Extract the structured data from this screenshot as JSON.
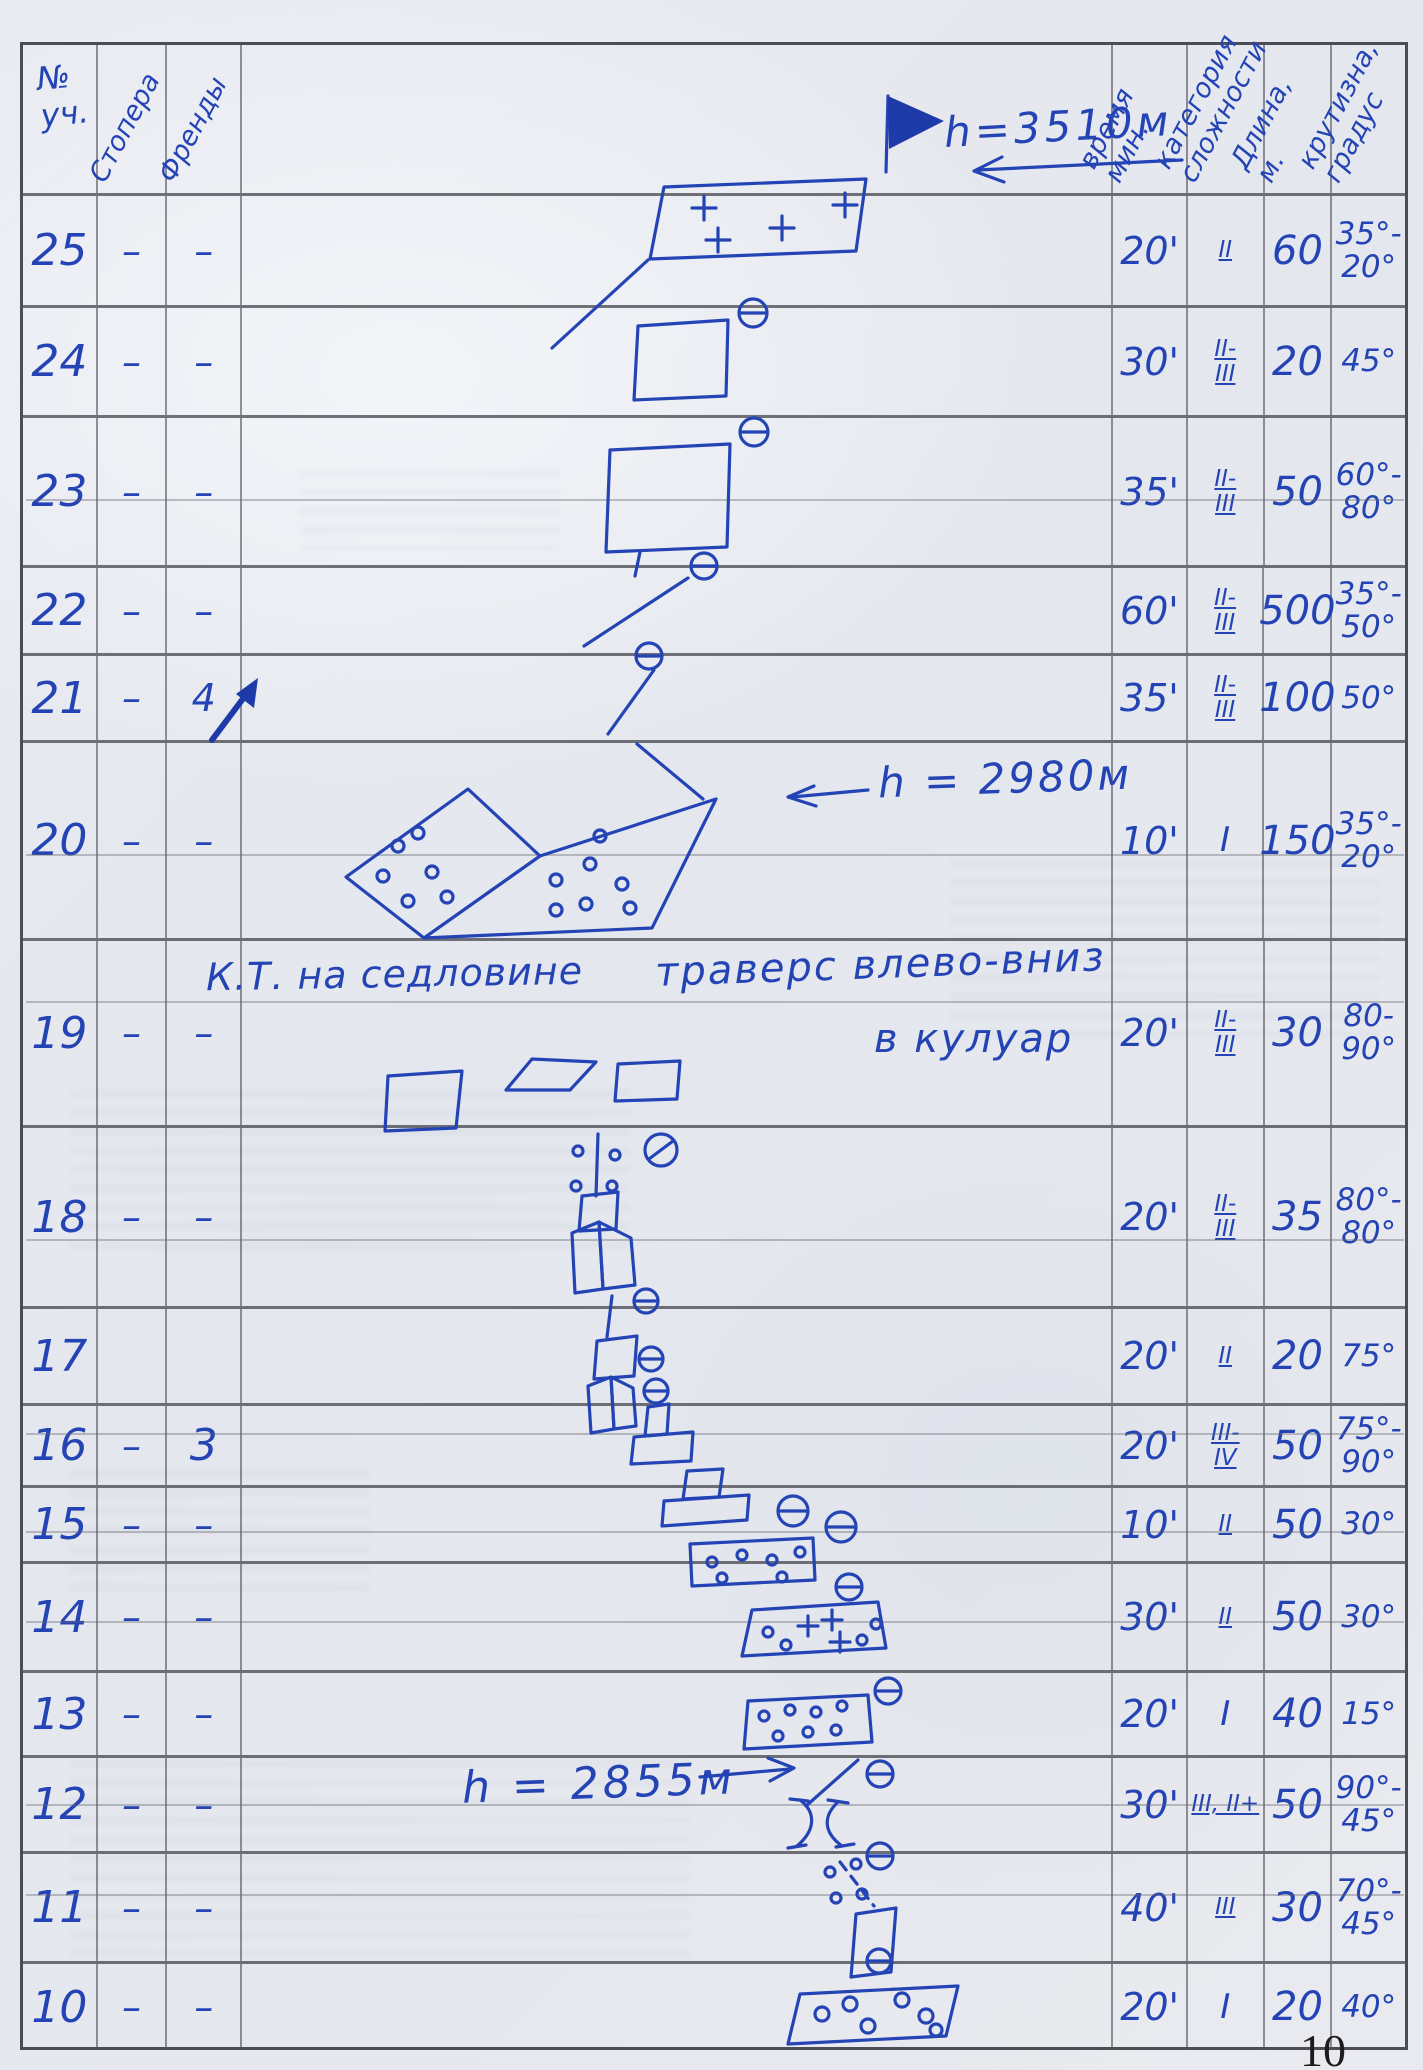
{
  "page": {
    "number": "10"
  },
  "header": {
    "col_num": "№\nуч.",
    "col_stoppers": "Стопера",
    "col_friends": "Френды",
    "col_time": "время\nмин.",
    "col_category": "категория\nсложности",
    "col_length": "Длина,\nм.",
    "col_steepness": "крутизна,\nградус"
  },
  "annotations": {
    "summit_height": "h=3510м",
    "saddle_height": "h = 2980м",
    "mid_height": "h = 2855м",
    "kt_note": "К.Т. на седловине",
    "traverse_note": "траверс влево-вниз",
    "couloir_note": "в кулуар"
  },
  "rows": [
    {
      "num": "25",
      "stoppers": "–",
      "friends": "–",
      "time": "20'",
      "category": "II",
      "length": "60",
      "steepness": "35°-\n20°"
    },
    {
      "num": "24",
      "stoppers": "–",
      "friends": "–",
      "time": "30'",
      "category": "II-\nIII",
      "length": "20",
      "steepness": "45°"
    },
    {
      "num": "23",
      "stoppers": "–",
      "friends": "–",
      "time": "35'",
      "category": "II-\nIII",
      "length": "50",
      "steepness": "60°-\n80°"
    },
    {
      "num": "22",
      "stoppers": "–",
      "friends": "–",
      "time": "60'",
      "category": "II-\nIII",
      "length": "500",
      "steepness": "35°-\n50°"
    },
    {
      "num": "21",
      "stoppers": "–",
      "friends": "4",
      "time": "35'",
      "category": "II-\nIII",
      "length": "100",
      "steepness": "50°"
    },
    {
      "num": "20",
      "stoppers": "–",
      "friends": "–",
      "time": "10'",
      "category": "I",
      "length": "150",
      "steepness": "35°-\n20°"
    },
    {
      "num": "19",
      "stoppers": "–",
      "friends": "–",
      "time": "20'",
      "category": "II-\nIII",
      "length": "30",
      "steepness": "80-\n90°"
    },
    {
      "num": "18",
      "stoppers": "–",
      "friends": "–",
      "time": "20'",
      "category": "II-\nIII",
      "length": "35",
      "steepness": "80°-\n80°"
    },
    {
      "num": "17",
      "stoppers": "",
      "friends": "",
      "time": "20'",
      "category": "II",
      "length": "20",
      "steepness": "75°"
    },
    {
      "num": "16",
      "stoppers": "–",
      "friends": "3",
      "time": "20'",
      "category": "III-\nIV",
      "length": "50",
      "steepness": "75°-\n90°"
    },
    {
      "num": "15",
      "stoppers": "–",
      "friends": "–",
      "time": "10'",
      "category": "II",
      "length": "50",
      "steepness": "30°"
    },
    {
      "num": "14",
      "stoppers": "–",
      "friends": "–",
      "time": "30'",
      "category": "II",
      "length": "50",
      "steepness": "30°"
    },
    {
      "num": "13",
      "stoppers": "–",
      "friends": "–",
      "time": "20'",
      "category": "I",
      "length": "40",
      "steepness": "15°"
    },
    {
      "num": "12",
      "stoppers": "–",
      "friends": "–",
      "time": "30'",
      "category": "III, II+",
      "length": "50",
      "steepness": "90°-\n45°"
    },
    {
      "num": "11",
      "stoppers": "–",
      "friends": "–",
      "time": "40'",
      "category": "III",
      "length": "30",
      "steepness": "70°-\n45°"
    },
    {
      "num": "10",
      "stoppers": "–",
      "friends": "–",
      "time": "20'",
      "category": "I",
      "length": "20",
      "steepness": "40°"
    }
  ]
}
